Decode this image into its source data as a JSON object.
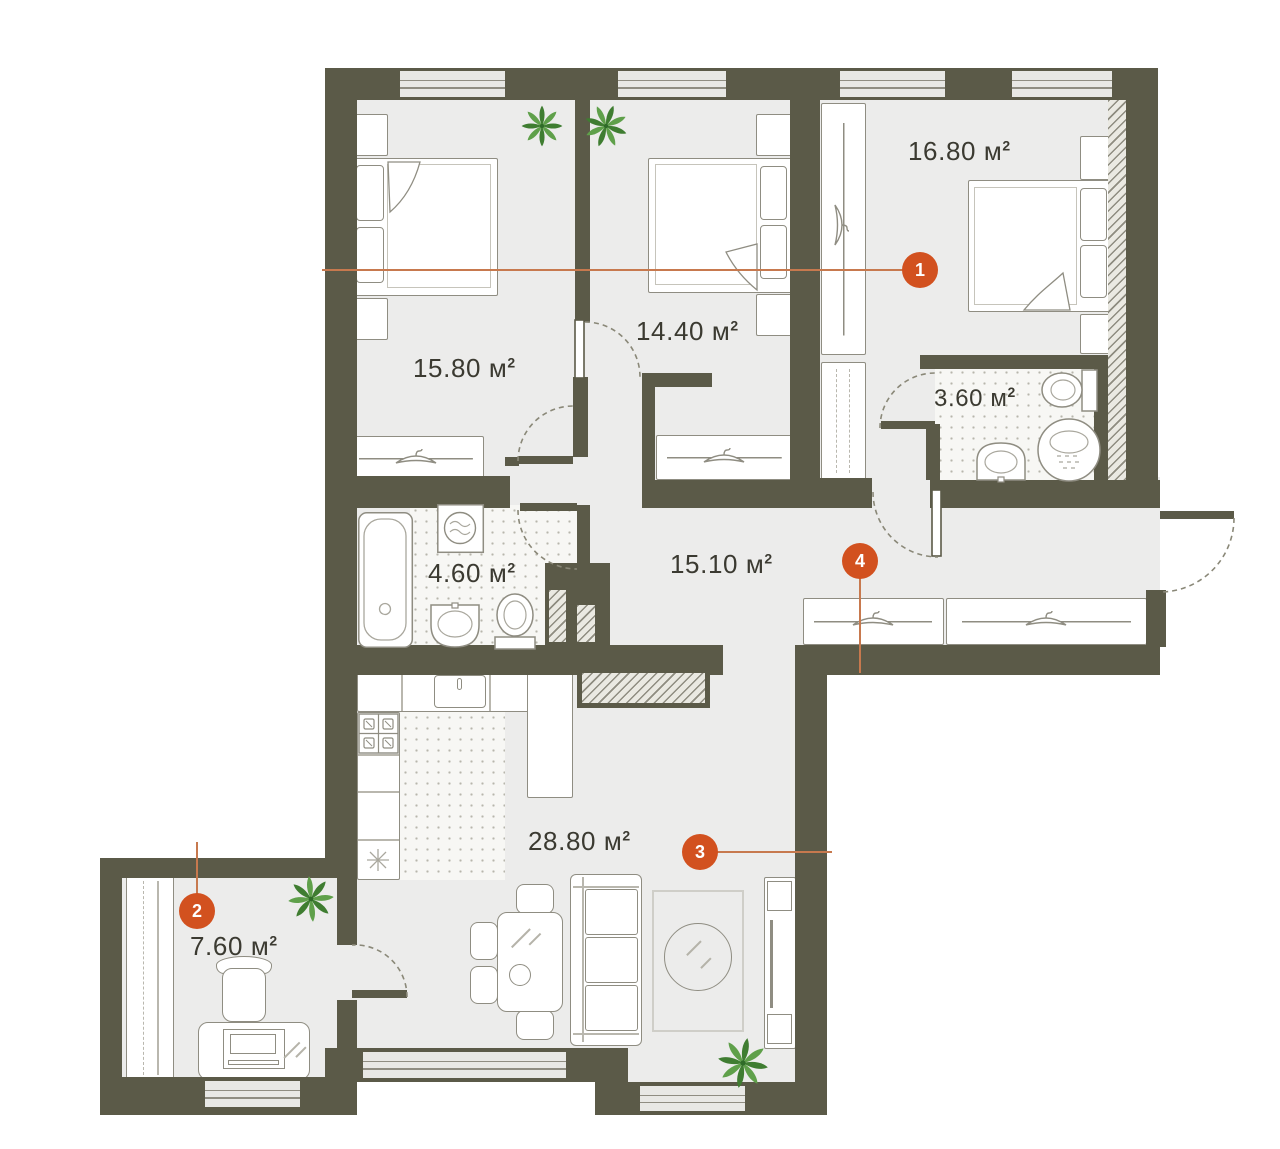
{
  "area_unit": "м",
  "area_unit_sup": "2",
  "rooms": [
    {
      "name": "bedroom-1",
      "area": "15.80"
    },
    {
      "name": "bedroom-2",
      "area": "14.40"
    },
    {
      "name": "bedroom-3",
      "area": "16.80"
    },
    {
      "name": "bathroom-small",
      "area": "3.60"
    },
    {
      "name": "bathroom",
      "area": "4.60"
    },
    {
      "name": "hallway",
      "area": "15.10"
    },
    {
      "name": "kitchen-living-room",
      "area": "28.80"
    },
    {
      "name": "cabinet",
      "area": "7.60"
    }
  ],
  "markers": [
    {
      "label": "1"
    },
    {
      "label": "2"
    },
    {
      "label": "3"
    },
    {
      "label": "4"
    }
  ],
  "colors": {
    "wall": "#5b5a48",
    "floor": "#ececeb",
    "accent": "#d2511f",
    "leader": "#c7794e",
    "outline": "#8f8d82",
    "label": "#3b3a31",
    "plant_dark": "#3f7d31",
    "plant_light": "#5fa04a"
  }
}
